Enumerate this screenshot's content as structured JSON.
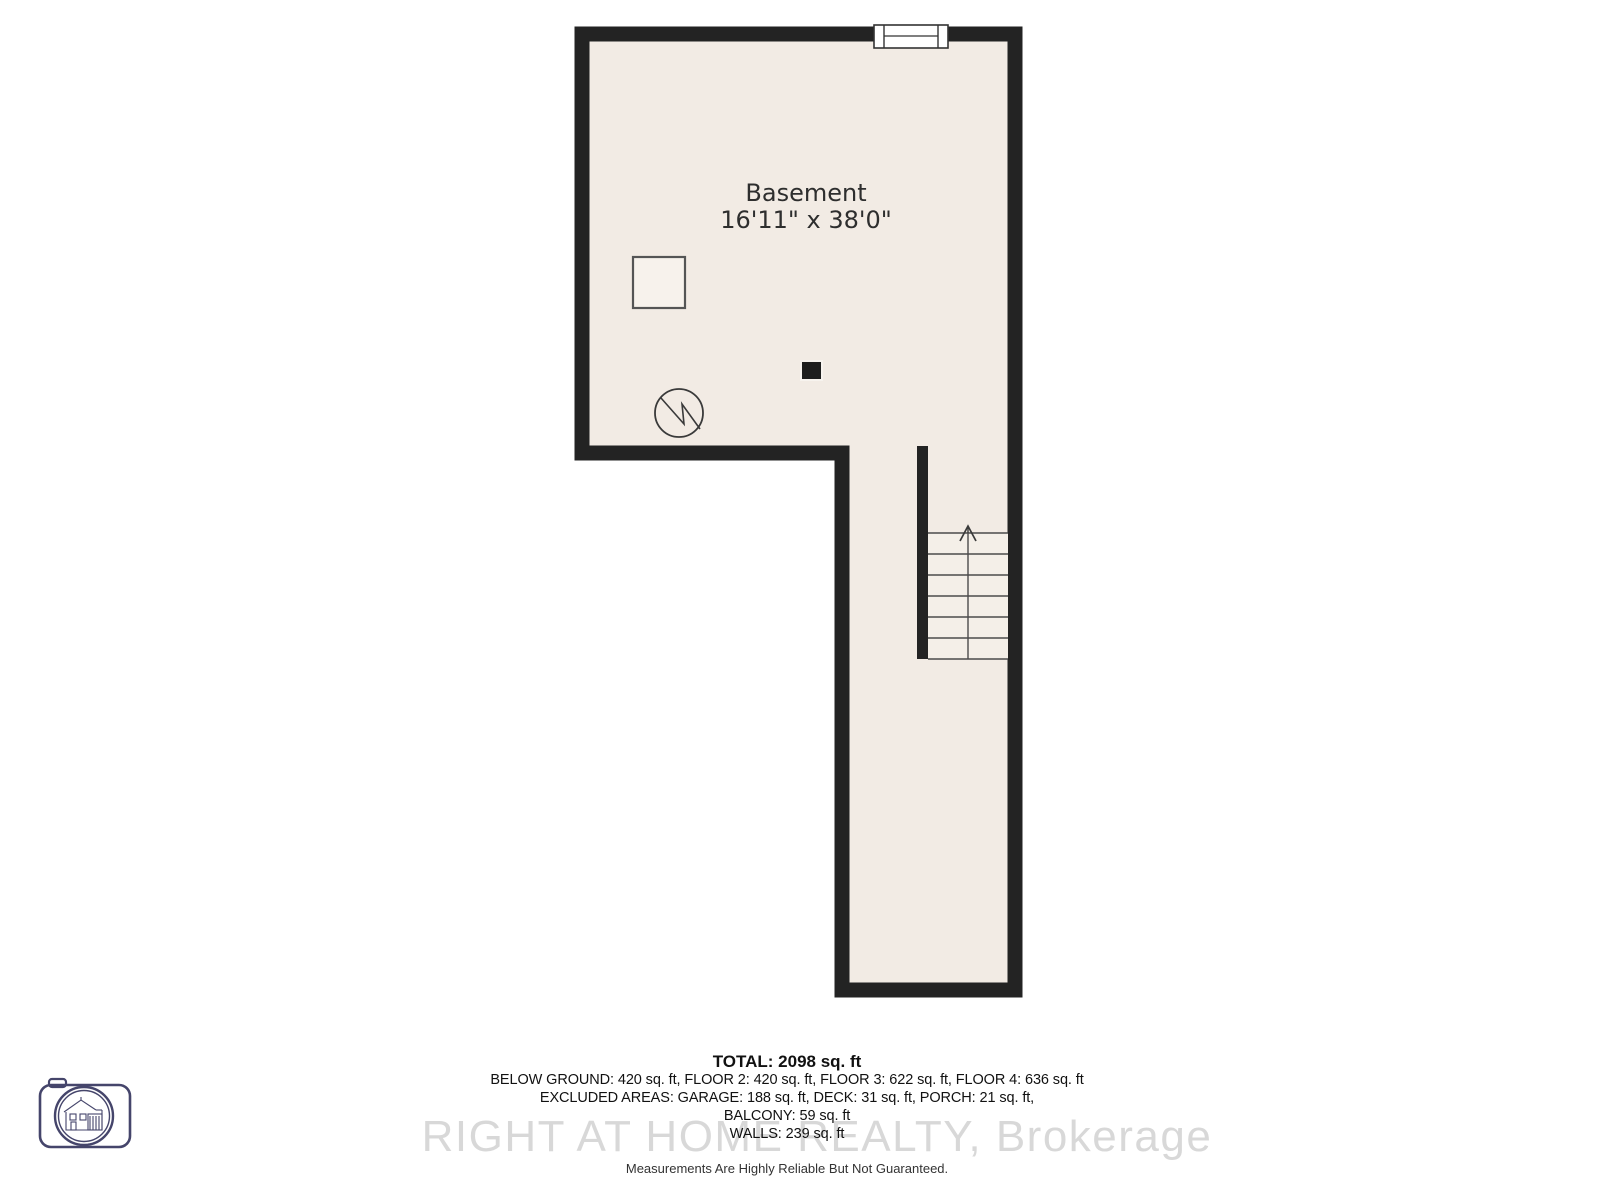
{
  "plan": {
    "room": {
      "label": "Basement",
      "dimensions": "16'11\" x 38'0\""
    },
    "symbols": [
      "window",
      "furnace",
      "water-heater",
      "support-column",
      "stairs-up-arrow"
    ]
  },
  "summary": {
    "total": "TOTAL: 2098 sq. ft",
    "floors_line": "BELOW GROUND: 420 sq. ft, FLOOR 2: 420 sq. ft, FLOOR 3: 622 sq. ft, FLOOR 4: 636 sq. ft",
    "excluded_line": "EXCLUDED AREAS: GARAGE: 188 sq. ft, DECK: 31 sq. ft, PORCH: 21 sq. ft,",
    "balcony_line": "BALCONY: 59 sq. ft",
    "walls_line": "WALLS: 239 sq. ft"
  },
  "branding": {
    "watermark": "RIGHT AT HOME REALTY, Brokerage",
    "logo_icon": "camera-house-logo"
  },
  "disclaimer": "Measurements Are Highly Reliable But Not Guaranteed.",
  "colors": {
    "wall": "#232323",
    "floor": "#f2ebe4",
    "stair_area": "#f4efe8",
    "logo_outline": "#45456b",
    "watermark_text": "#d8d8d8"
  }
}
